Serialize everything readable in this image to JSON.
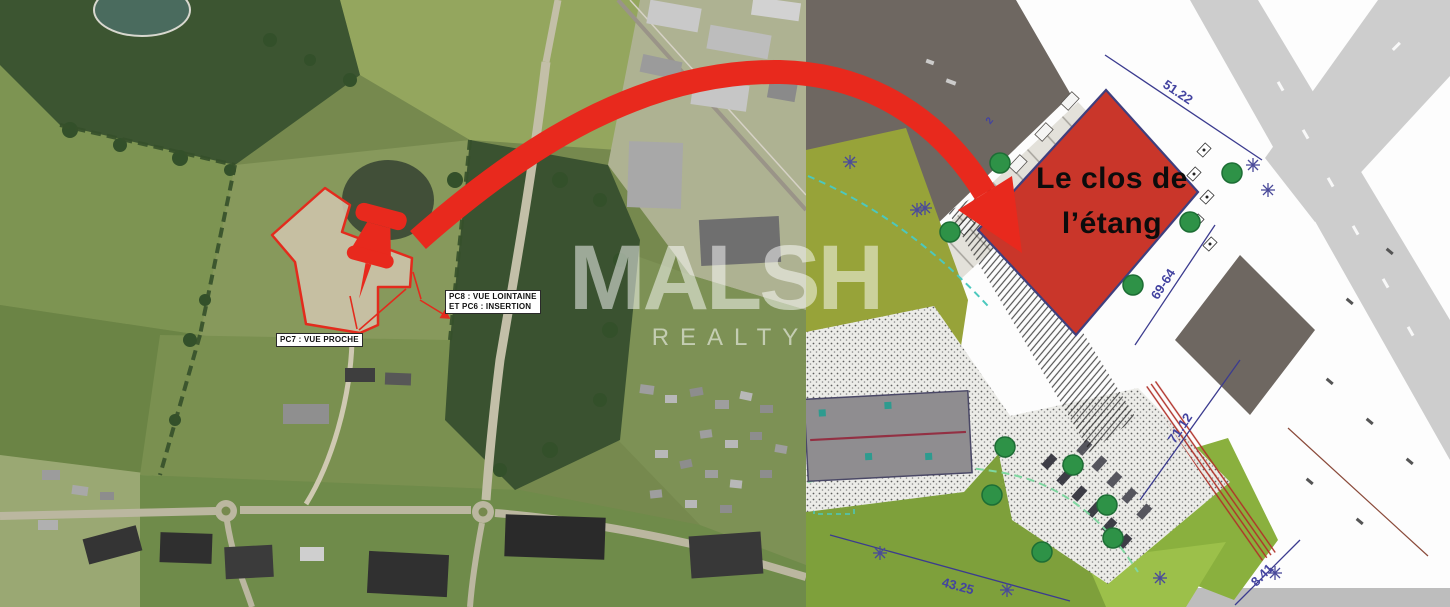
{
  "watermark": {
    "brand": "MALSH",
    "subbrand": "REALTY"
  },
  "aerial": {
    "pc7_label": "PC7 : VUE PROCHE",
    "pc8_label_line1": "PC8 : VUE LOINTAINE",
    "pc8_label_line2": "ET PC6 : INSERTION"
  },
  "plan": {
    "title_line1": "Le clos de",
    "title_line2": "l’étang",
    "dimensions": [
      {
        "label": "51.22"
      },
      {
        "label": "69-64"
      },
      {
        "label": "71.12"
      },
      {
        "label": "43.25"
      },
      {
        "label": "8.41"
      },
      {
        "label": "2"
      }
    ]
  },
  "colors": {
    "accent_red": "#e8291d",
    "proposed_building_fill": "#c9362a",
    "dimension_blue": "#4343a0",
    "tree_green": "#2e9247",
    "lawn_green": "#7ea03b",
    "road_gray": "#cdcdcd"
  }
}
